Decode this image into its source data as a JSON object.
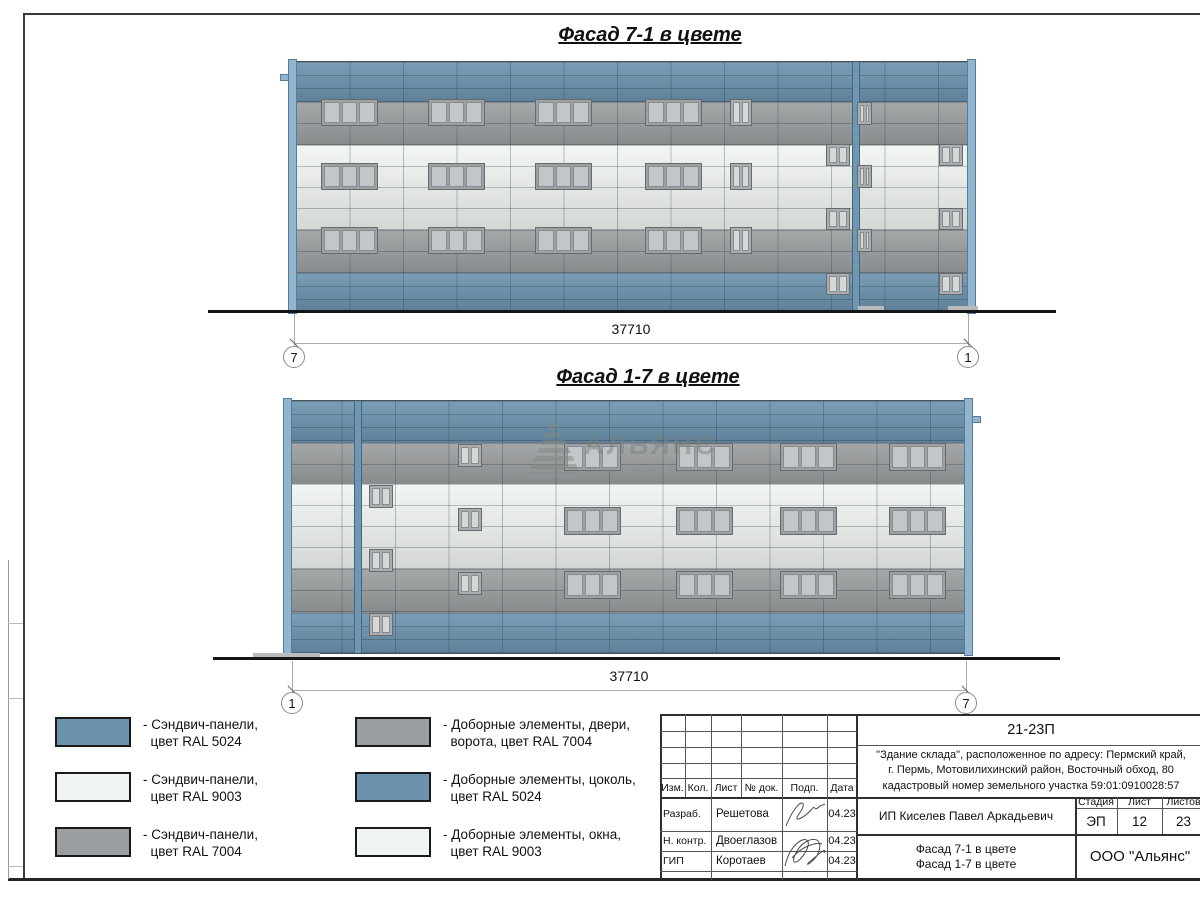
{
  "colors": {
    "ral5024_blue": "#6b93ae",
    "ral9003_white": "#f1f5f1",
    "ral7004_gray": "#9b9ea0",
    "pilaster_blue": "#92b4cd",
    "window_pane": "#c3c6c8"
  },
  "facades": [
    {
      "title": "Фасад 7-1 в цвете",
      "dimension": "37710",
      "marker_left": "7",
      "marker_right": "1"
    },
    {
      "title": "Фасад 1-7 в цвете",
      "dimension": "37710",
      "marker_left": "1",
      "marker_right": "7"
    }
  ],
  "watermark": {
    "name": "АЛЬЯНС",
    "tagline": "строительная компания"
  },
  "legend": [
    {
      "swatch": "ral5024_blue",
      "line1": "- Сэндвич-панели,",
      "line2": "цвет RAL 5024"
    },
    {
      "swatch": "ral9003_white",
      "line1": "- Сэндвич-панели,",
      "line2": "цвет RAL 9003"
    },
    {
      "swatch": "ral7004_gray",
      "line1": "- Сэндвич-панели,",
      "line2": "цвет RAL 7004"
    },
    {
      "swatch": "ral7004_gray",
      "line1": "- Доборные элементы, двери,",
      "line2": "ворота, цвет RAL 7004"
    },
    {
      "swatch": "ral5024_blue",
      "line1": "- Доборные элементы, цоколь,",
      "line2": "цвет RAL 5024"
    },
    {
      "swatch": "ral9003_white",
      "line1": "- Доборные элементы, окна,",
      "line2": "цвет RAL 9003"
    }
  ],
  "titleblock": {
    "doc_number": "21-23П",
    "description_line1": "\"Здание склада\", расположенное по адресу: Пермский край,",
    "description_line2": "г. Пермь, Мотовилихинский район, Восточный обход, 80",
    "description_line3": "кадастровый номер земельного участка 59:01:0910028:57",
    "rev_headers": [
      "Изм.",
      "Кол.",
      "Лист",
      "№ док.",
      "Подп.",
      "Дата"
    ],
    "signers": [
      {
        "role": "Разраб.",
        "name": "Решетова",
        "date": "04.23"
      },
      {
        "role": "Н. контр.",
        "name": "Двоеглазов",
        "date": "04.23"
      },
      {
        "role": "ГИП",
        "name": "Коротаев",
        "date": "04.23"
      }
    ],
    "client": "ИП Киселев Павел Аркадьевич",
    "stage_label": "Стадия",
    "sheet_label": "Лист",
    "sheets_label": "Листов",
    "stage": "ЭП",
    "sheet_no": "12",
    "sheets_total": "23",
    "drawing_title_line1": "Фасад 7-1 в цвете",
    "drawing_title_line2": "Фасад 1-7 в цвете",
    "company": "ООО \"Альянс\""
  }
}
